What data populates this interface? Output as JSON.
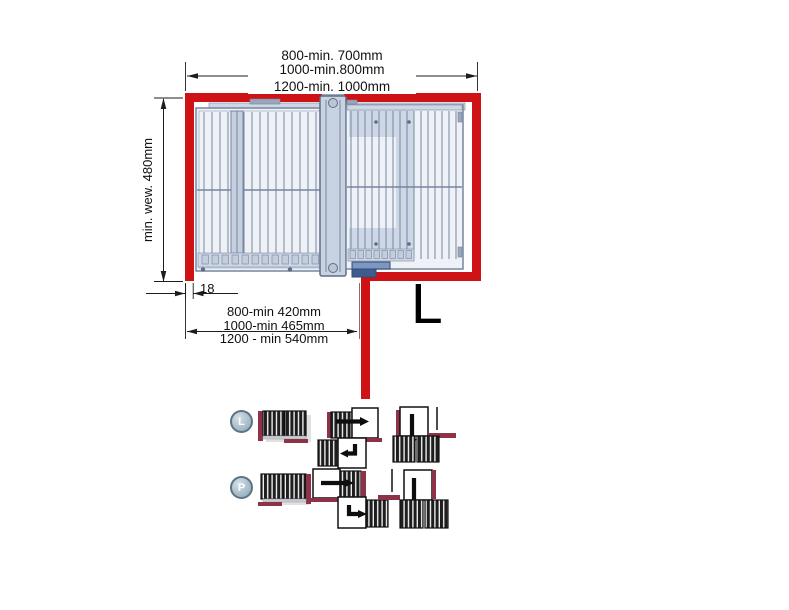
{
  "dimensions": {
    "top": [
      "800-min. 700mm",
      "1000-min.800mm",
      "1200-min. 1000mm"
    ],
    "left": "min. wew. 480mm",
    "wall_thickness": "18",
    "bottom": [
      "800-min 420mm",
      "1000-min 465mm",
      "1200 - min 540mm"
    ]
  },
  "orientation_letter": "L",
  "variants": {
    "left_badge": "L",
    "right_badge": "P"
  },
  "colors": {
    "wall_red": "#cf1215",
    "maroon": "#8e3247",
    "basket_line": "#76869f",
    "basket_fill": "#eef1f6",
    "panel_fill": "#cdd7e5",
    "dim": "#1d1d1d"
  }
}
